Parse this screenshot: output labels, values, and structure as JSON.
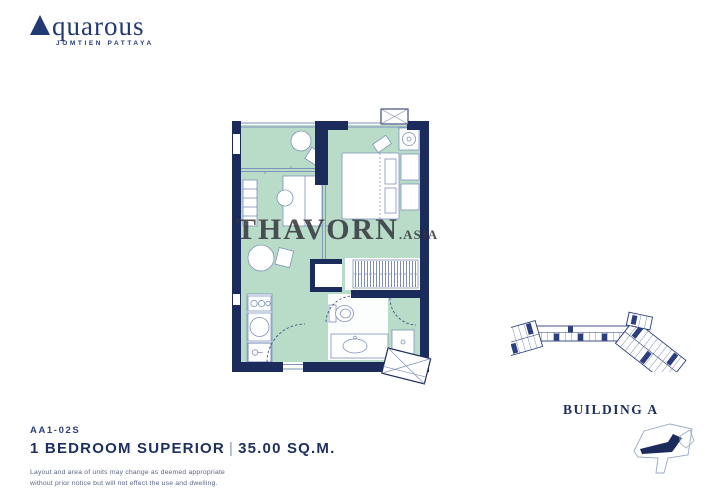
{
  "colors": {
    "navy": "#1b2b5c",
    "logo_navy": "#223a73",
    "mint": "#b9dcc9",
    "thin_line": "#7e92bb",
    "watermark": "#34353b"
  },
  "brand": {
    "name": "Aquarous",
    "initial": "A",
    "rest": "quarous",
    "tagline": "JOMTIEN PATTAYA"
  },
  "watermark": {
    "main": "THAVORN",
    "suffix": ".ASIA"
  },
  "unit": {
    "code": "AA1-02S",
    "type": "1 BEDROOM SUPERIOR",
    "separator": "|",
    "area": "35.00 SQ.M."
  },
  "disclaimer": {
    "line1": "Layout and area of units may change as deemed appropriate",
    "line2": "without prior notice but will not effect the use and dwelling."
  },
  "building": {
    "label": "BUILDING A"
  }
}
